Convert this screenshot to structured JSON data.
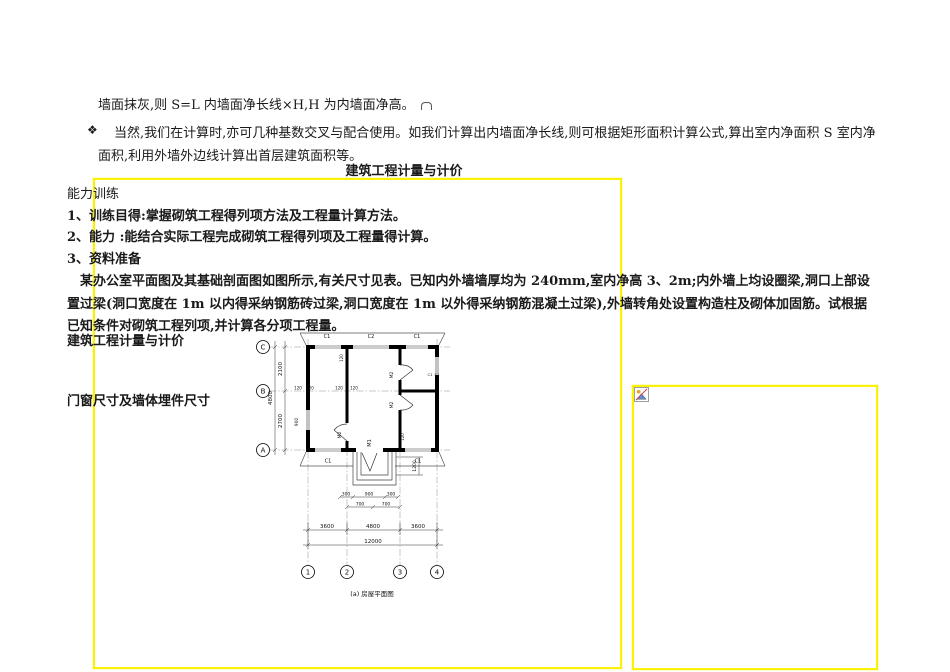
{
  "page": {
    "background": "#ffffff",
    "frame_border_color": "#fbf104"
  },
  "intro": {
    "line1": "墙面抹灰,则 S=L 内墙面净长线×H,H 为内墙面净高。",
    "bullet_glyph": "❖",
    "para2": "当然,我们在计算时,亦可几种基数交叉与配合使用。如我们计算出内墙面净长线,则可根据矩形面积计算公式,算出室内净面积 S 室内净面积,利用外墙外边线计算出首层建筑面积等。",
    "title": "建筑工程计量与计价"
  },
  "worksheet": {
    "section": "能力训练",
    "items": [
      "1、训练目得:掌握砌筑工程得列项方法及工程量计算方法。",
      "2、能力  :能结合实际工程完成砌筑工程得列项及工程量得计算。",
      "3、资料准备"
    ],
    "problem": "某办公室平面图及其基础剖面图如图所示,有关尺寸见表。已知内外墙墙厚均为 240mm,室内净高 3、2m;内外墙上均设圈梁,洞口上部设置过梁(洞口宽度在 1m 以内得采纳钢筋砖过梁,洞口宽度在 1m 以外得采纳钢筋混凝土过梁),外墙转角处设置构造柱及砌体加固筋。试根据已知条件对砌筑工程列项,并计算各分项工程量。",
    "subtitle1": "建筑工程计量与计价",
    "subtitle2": "门窗尺寸及墙体埋件尺寸"
  },
  "plan": {
    "caption": "(a) 房屋平面图",
    "axes": {
      "c": "C",
      "b": "B",
      "a": "A",
      "n1": "1",
      "n2": "2",
      "n3": "3",
      "n4": "4"
    },
    "dims": {
      "left_top": "2100",
      "left_bottom": "2700",
      "left_total": "4800",
      "bay_side": "3600",
      "bay_mid": "4800",
      "total": "12000",
      "d120": "120",
      "d300": "300",
      "d700": "700",
      "d900": "900",
      "d1200": "1200"
    },
    "tags": {
      "c1": "C1",
      "c2": "C2",
      "m1": "M1",
      "m2": "M2"
    }
  },
  "placeholder": {
    "icon": "broken-image"
  }
}
